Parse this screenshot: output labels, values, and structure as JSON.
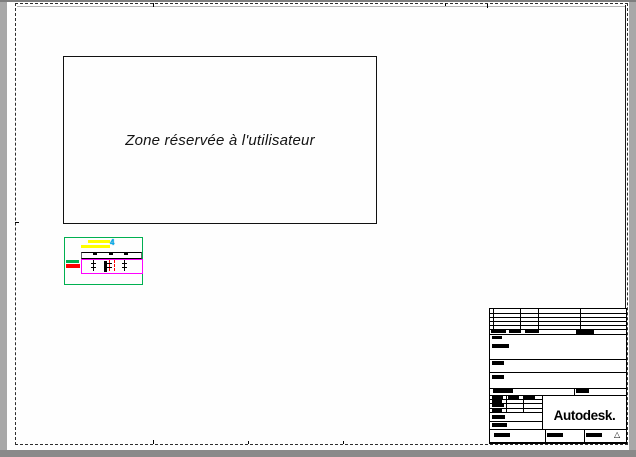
{
  "sheet": {
    "background_color": "#a8a8a8",
    "paper_color": "#fefefe"
  },
  "user_zone": {
    "label": "Zone réservée à l'utilisateur"
  },
  "drawing_preview": {
    "marker_glyph": "4",
    "colors": {
      "viewport_frame": "#00b050",
      "bar_yellow": "#ffff00",
      "bar_green": "#00b050",
      "bar_red": "#ff0000",
      "slab_magenta": "#ff00ff",
      "marker_cyan": "#00aeef"
    }
  },
  "title_block": {
    "logo_text": "Autodesk.",
    "revision_marker": "△"
  }
}
